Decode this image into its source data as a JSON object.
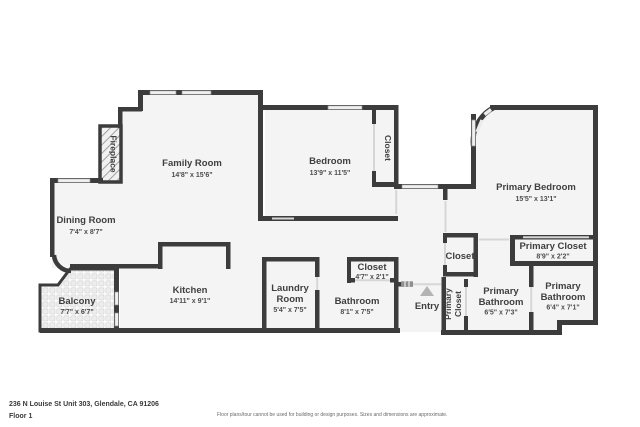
{
  "rooms": {
    "family": {
      "name": "Family Room",
      "dims": "14'8\" x 15'6\""
    },
    "dining": {
      "name": "Dining Room",
      "dims": "7'4\" x 8'7\""
    },
    "bedroom": {
      "name": "Bedroom",
      "dims": "13'9\" x 11'5\""
    },
    "bedroom_closet": {
      "name": "Closet"
    },
    "primary_bedroom": {
      "name": "Primary Bedroom",
      "dims": "15'5\" x 13'1\""
    },
    "primary_closet": {
      "name": "Primary Closet",
      "dims": "8'9\" x 2'2\""
    },
    "hall_closet": {
      "name": "Closet"
    },
    "entry_closet": {
      "name": "Closet",
      "dims": "4'7\" x 2'1\""
    },
    "bathroom": {
      "name": "Bathroom",
      "dims": "8'1\" x 7'5\""
    },
    "laundry": {
      "line1": "Laundry",
      "line2": "Room",
      "dims": "5'4\" x 7'5\""
    },
    "kitchen": {
      "name": "Kitchen",
      "dims": "14'11\" x 9'1\""
    },
    "balcony": {
      "name": "Balcony",
      "dims": "7'7\" x 6'7\""
    },
    "entry": {
      "name": "Entry"
    },
    "primary_closet_hall": {
      "word1": "Primary",
      "word2": "Closet"
    },
    "primary_bath_a": {
      "line1": "Primary",
      "line2": "Bathroom",
      "dims": "6'5\" x 7'3\""
    },
    "primary_bath_b": {
      "line1": "Primary",
      "line2": "Bathroom",
      "dims": "6'4\" x 7'1\""
    },
    "fireplace": {
      "name": "Fireplace"
    }
  },
  "footer": {
    "address": "236 N Louise St Unit 303, Glendale, CA 91206",
    "floor_label": "Floor 1",
    "disclaimer": "Floor plans/tour cannot be used for building or design purposes. Sizes and dimensions are approximate."
  },
  "colors": {
    "wall": "#3c3c3c",
    "floor": "#f4f4f4",
    "window": "#efefef",
    "label": "#3f3f3f"
  }
}
